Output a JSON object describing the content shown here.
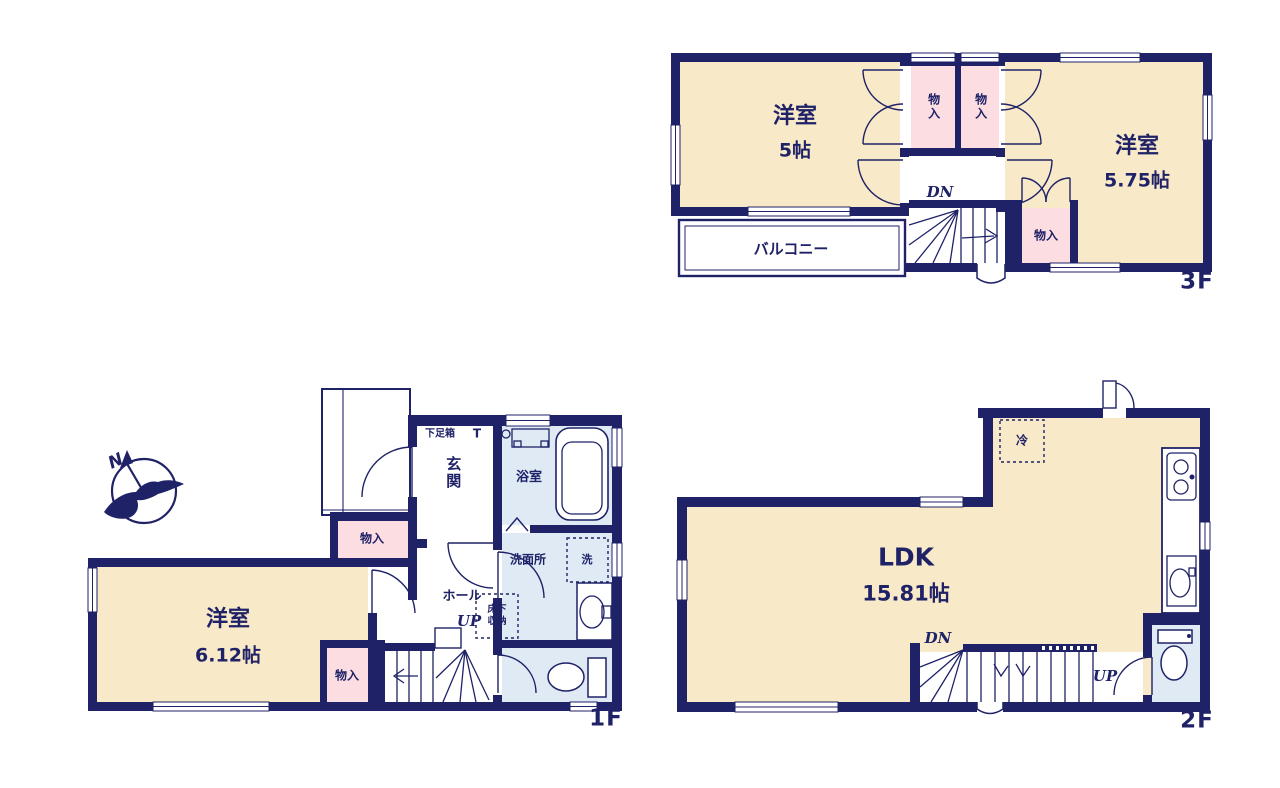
{
  "colors": {
    "wall_navy": "#1f2267",
    "room_cream": "#f8e9c8",
    "closet_pink": "#fbdde2",
    "wet_area_blue": "#dfeaf5",
    "background": "#ffffff"
  },
  "floors": {
    "f1": {
      "floor_label": "1F",
      "compass_n": "N",
      "room_west": {
        "name": "洋室",
        "size": "6.12帖"
      },
      "entrance": "玄関",
      "shoe_cabinet": "下足箱",
      "shoe_cabinet_t": "T",
      "bathroom": "浴室",
      "washroom": "洗面所",
      "washer": "洗",
      "underfloor_storage": "床下収納",
      "hall": "ホール",
      "stairs_up": "UP",
      "closet_mid": "物入",
      "closet_bottom": "物入"
    },
    "f2": {
      "floor_label": "2F",
      "ldk": {
        "name": "LDK",
        "size": "15.81帖"
      },
      "fridge": "冷",
      "stairs_dn": "DN",
      "stairs_up": "UP"
    },
    "f3": {
      "floor_label": "3F",
      "room_west": {
        "name": "洋室",
        "size": "5帖"
      },
      "room_east": {
        "name": "洋室",
        "size": "5.75帖"
      },
      "closet_top_left": "物入",
      "closet_top_right": "物入",
      "closet_bottom": "物入",
      "balcony": "バルコニー",
      "stairs_dn": "DN"
    }
  }
}
